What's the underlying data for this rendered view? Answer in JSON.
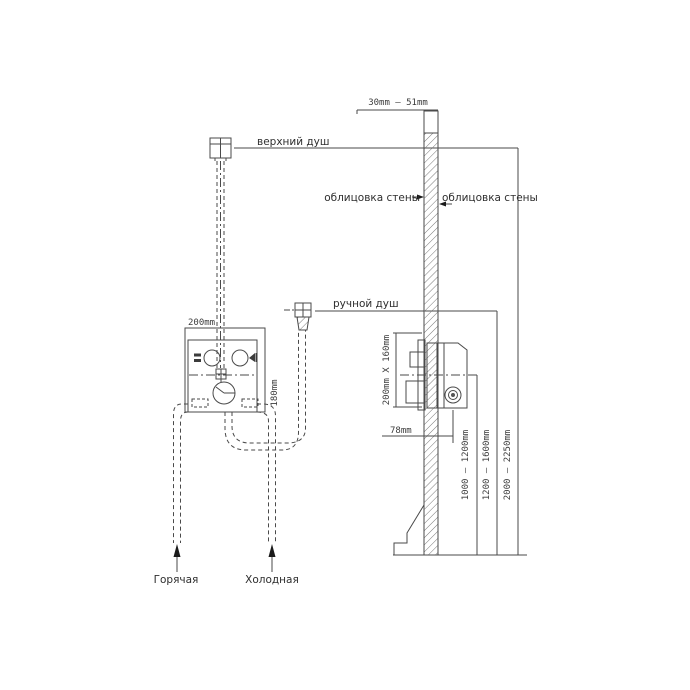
{
  "drawing": {
    "labels": {
      "top_shower": "верхний душ",
      "hand_shower": "ручной душ",
      "wall_cladding_left": "облицовка стены",
      "wall_cladding_right": "облицовка стены",
      "hot_supply": "Горячая",
      "cold_supply": "Холодная"
    },
    "dimensions": {
      "wall_thickness": "30mm – 51mm",
      "mixer_width": "200mm",
      "mixer_height": "180mm",
      "rough_in_size": "200mm X 160mm",
      "mixer_depth": "78mm",
      "mixer_mount_height": "1000 – 1200mm",
      "hand_shower_mount_height": "1200 – 1600mm",
      "top_shower_mount_height": "2000 – 2250mm"
    },
    "colors": {
      "line": "#4a4a4a",
      "text": "#333333",
      "background": "#ffffff"
    }
  }
}
